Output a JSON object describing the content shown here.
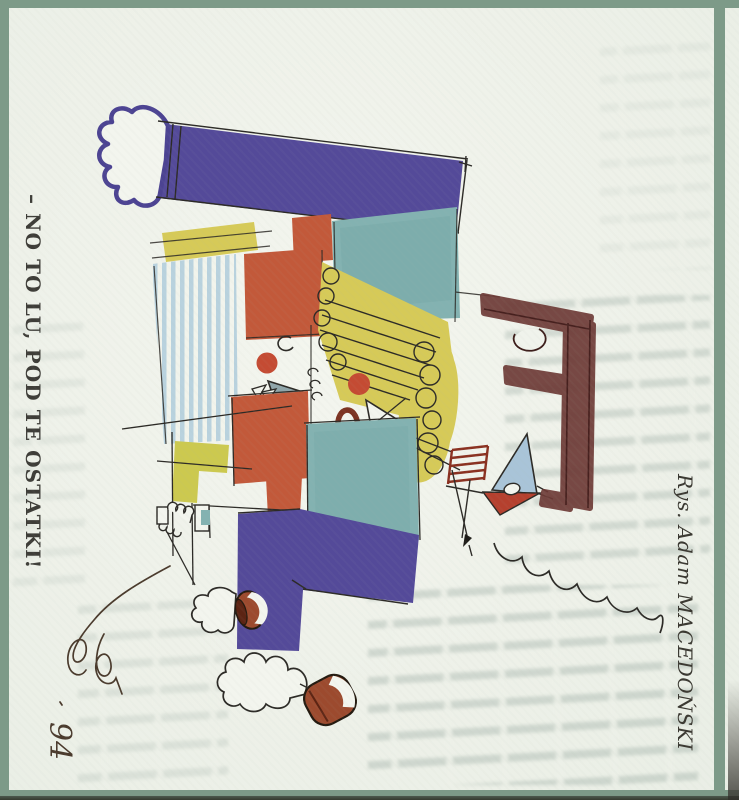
{
  "captions": {
    "exclamation": "– NO TO LU, POD TE OSTATKI!",
    "credit": "Rys. Adam MACEDOŃSKI"
  },
  "signature": {
    "year": "94"
  },
  "palette": {
    "frame_green": "#7d9a88",
    "paper": "#eef1e9",
    "purple": "#544a99",
    "teal": "#83b2b1",
    "teal_light": "#a9c4d8",
    "stripe_blue": "#b9d2de",
    "orange": "#c2593a",
    "red_nose": "#c44b33",
    "mouth_red": "#7c3322",
    "yellow": "#d6ca58",
    "yellow_green": "#ccc94f",
    "beak_gray": "#90a6aa",
    "brown": "#6d3a36",
    "mug_brown": "#9c4a2e",
    "stand_red": "#8a3020",
    "ink": "#2c2a26"
  }
}
